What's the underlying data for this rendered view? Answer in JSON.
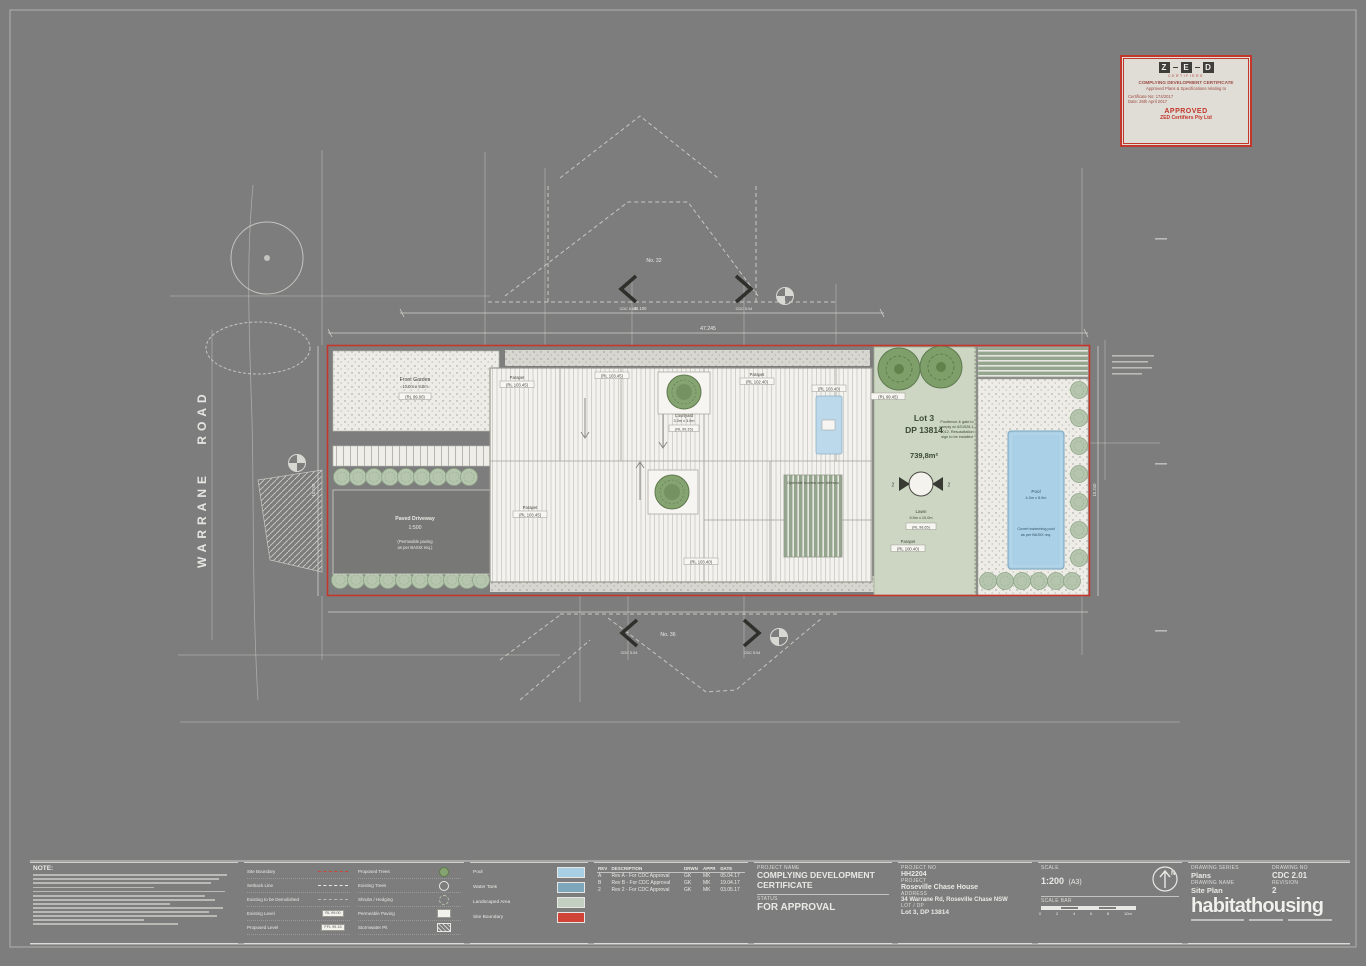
{
  "stamp": {
    "logo_letters": [
      "Z",
      "E",
      "D"
    ],
    "logo_sub": "CERTIFIERS",
    "line1": "COMPLYING DEVELOPMENT CERTIFICATE",
    "line2": "Approved Plans & Specifications relating to",
    "cert_no": "Certificate No: 174/2017",
    "date": "Date: 26th April 2017",
    "approved": "APPROVED",
    "company": "ZED Certifiers Pty Ltd"
  },
  "plan": {
    "road_name": "WARRANE ROAD",
    "lot_title": "Lot 3",
    "lot_dp": "DP 13814",
    "lot_area": "739,8m²",
    "lawn_label": "Lawn",
    "lawn_size": "5.5m x 10.0m",
    "lawn_rl": "(RL 98.65)",
    "pool_label": "Pool",
    "pool_size": "4.0m x 8.0m",
    "pool_note1": "Covert swimming pool",
    "pool_note2": "as per BASIX req.",
    "front_garden_label": "Front Garden",
    "front_garden_size": "10.0m x 8.0m",
    "front_garden_rl": "(RL 99.00)",
    "driveway_label": "Paved Driveway",
    "driveway_grade": "1:500",
    "driveway_note1": "(Permeable paving",
    "driveway_note2": "as per BASIX req.)",
    "courtyard_label": "Courtyard",
    "courtyard_size": "3.0m x 3.0m",
    "courtyard_rl": "(RL 99.15)",
    "louvre_note": "Operable louvres over alfresco",
    "poolfence_note_lines": [
      "Poolfence & gate to",
      "comply w/ AS1926.1-",
      "2012. Resuscitation",
      "sign to be installed"
    ],
    "neighbour_top": "No. 32",
    "neighbour_bottom": "No. 36",
    "section_marker": "CDC 5.04",
    "section_bubble_num": "2",
    "parapet_word": "Parapet",
    "rl_boxes": [
      "(RL 103.45)",
      "(RL 103.45)",
      "(RL 102.40)",
      "(RL 103.45)",
      "(RL 103.40)",
      "(RL 103.40)",
      "(RL 99.45)",
      "(RL 100.40)"
    ],
    "dim_top": "47.245",
    "dim_top2": "38.100",
    "dim_side_left": "15.240",
    "dim_side_right": "15.240"
  },
  "titleblock": {
    "notes": {
      "title": "NOTE:",
      "bar_widths": [
        96,
        92,
        88,
        60,
        95,
        85,
        90,
        68,
        94,
        87,
        91,
        55,
        72
      ]
    },
    "legend": {
      "left": [
        {
          "label": "Site Boundary"
        },
        {
          "label": "Setback Line"
        },
        {
          "label": "Existing to be Demolished"
        },
        {
          "label": "Existing Level",
          "tag": "RL 99.00"
        },
        {
          "label": "Proposed Level",
          "tag": "FFL 99.15"
        }
      ],
      "right": [
        {
          "label": "Proposed Trees"
        },
        {
          "label": "Existing Trees"
        },
        {
          "label": "Shrubs / Hedging"
        },
        {
          "label": "Permeable Paving"
        },
        {
          "label": "Stormwater Pit"
        }
      ]
    },
    "color_legend": {
      "items": [
        {
          "label": "Pool",
          "color": "#a9cfe5"
        },
        {
          "label": "Water Tank",
          "color": "#7fa7bc"
        },
        {
          "label": "Landscaped Area",
          "color": "#c3cfc0"
        },
        {
          "label": "Site Boundary",
          "color": "#cf4437"
        }
      ]
    },
    "revisions": {
      "headers": [
        "REV",
        "DESCRIPTION",
        "DRWN",
        "APPR",
        "DATE"
      ],
      "rows": [
        [
          "A",
          "Rev A - For CDC Approval",
          "GK",
          "MK",
          "05.04.17"
        ],
        [
          "B",
          "Rev B - For CDC Approval",
          "GK",
          "MK",
          "19.04.17"
        ],
        [
          "2",
          "Rev 2 - For CDC Approval",
          "GK",
          "MK",
          "03.05.17"
        ]
      ]
    },
    "project": {
      "name_label": "PROJECT NAME",
      "name": "COMPLYING DEVELOPMENT CERTIFICATE",
      "status_label": "STATUS",
      "status": "FOR APPROVAL"
    },
    "info": {
      "no_label": "PROJECT NO",
      "no": "HH2204",
      "project_label": "PROJECT",
      "project": "Roseville Chase House",
      "address_label": "ADDRESS",
      "address": "34 Warrane Rd, Roseville Chase NSW",
      "lot_label": "LOT / DP",
      "lot": "Lot 3, DP 13814"
    },
    "scale": {
      "scale_label": "SCALE",
      "scale": "1:200",
      "sheet": "(A3)",
      "bar_label": "SCALE BAR",
      "ticks": [
        "0",
        "2",
        "4",
        "6",
        "8",
        "10m"
      ],
      "contact_bar_widths": [
        34,
        22,
        28
      ]
    },
    "drawing": {
      "series_label": "DRAWING SERIES",
      "series": "Plans",
      "name_label": "DRAWING NAME",
      "name": "Site Plan",
      "no_label": "DRAWING NO",
      "no": "CDC 2.01",
      "rev_label": "REVISION",
      "rev": "2",
      "logo": "habitathousing"
    }
  }
}
